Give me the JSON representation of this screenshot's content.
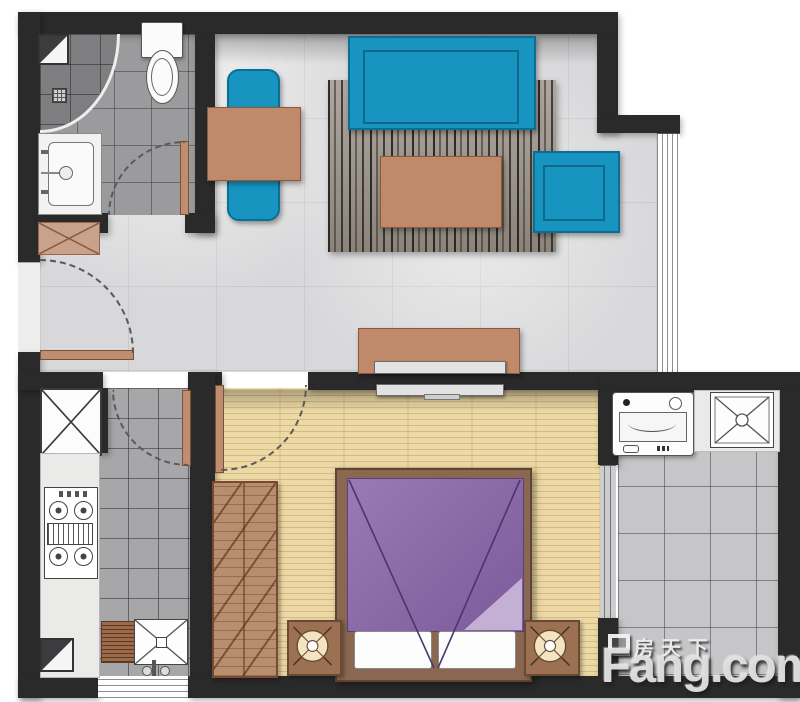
{
  "watermark": {
    "site_cn": "房天下",
    "site_en": "Fang.com"
  },
  "palette": {
    "wall": "#2a2a2a",
    "teal_furniture": "#1795c0",
    "wood_brown": "#c08a6a",
    "bed_purple": "#8d68a8",
    "bedroom_wood_floor": "#ecd9a6",
    "main_tile_floor": "#d8d8da",
    "bath_tile_floor": "#9b9b9d",
    "balcony_tile_floor": "#c6c6c8",
    "rug_dark": "#4a443c"
  },
  "rooms": {
    "bathroom": {
      "fixtures": [
        "shower-corner",
        "toilet",
        "vanity-sink",
        "floor-drain",
        "swing-door"
      ]
    },
    "entry": {
      "fixtures": [
        "entry-door",
        "shoe-cabinet"
      ]
    },
    "dining": {
      "fixtures": [
        "dining-table",
        "chair-top",
        "chair-bottom"
      ]
    },
    "living": {
      "fixtures": [
        "sofa",
        "rug",
        "coffee-table",
        "side-table",
        "tv-cabinet",
        "tv",
        "full-height-window"
      ]
    },
    "kitchen": {
      "fixtures": [
        "shaft-box",
        "counter",
        "gas-stove",
        "sink-with-drainboard",
        "floor-drain",
        "window",
        "swing-door"
      ]
    },
    "bedroom": {
      "fixtures": [
        "wardrobe",
        "double-bed",
        "pillow",
        "pillow",
        "nightstand-left",
        "nightstand-right",
        "tv",
        "swing-door"
      ]
    },
    "balcony": {
      "fixtures": [
        "washing-machine",
        "utility-sink",
        "sliding-glass-door"
      ]
    }
  }
}
